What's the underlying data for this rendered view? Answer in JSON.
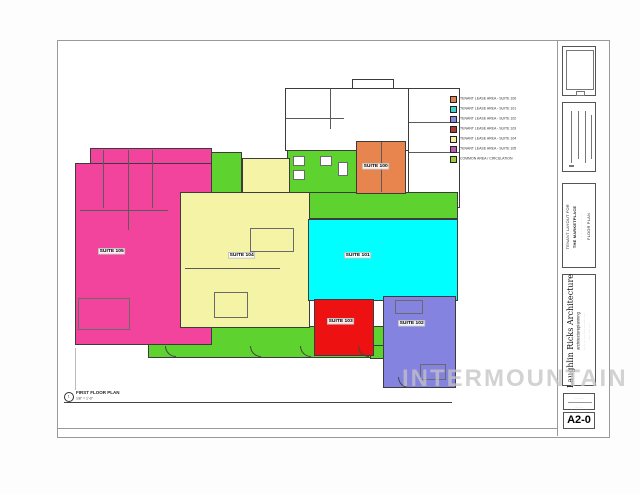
{
  "watermark": "INTERMOUNTAIN",
  "drawing_label": {
    "number": "1",
    "title": "FIRST FLOOR PLAN",
    "scale": "1/8\" = 1'-0\""
  },
  "legend": {
    "items": [
      {
        "label": "TENANT LEASE AREA - SUITE 100",
        "color": "#e0824c"
      },
      {
        "label": "TENANT LEASE AREA - SUITE 101",
        "color": "#44cfcb"
      },
      {
        "label": "TENANT LEASE AREA - SUITE 102",
        "color": "#8886dd"
      },
      {
        "label": "TENANT LEASE AREA - SUITE 103",
        "color": "#b23a34"
      },
      {
        "label": "TENANT LEASE AREA - SUITE 104",
        "color": "#f2efa0"
      },
      {
        "label": "TENANT LEASE AREA - SUITE 105",
        "color": "#b75bb0"
      },
      {
        "label": "COMMON AREA / CIRCULATION",
        "color": "#9acd3c"
      }
    ]
  },
  "suites": [
    {
      "id": "suite-100",
      "label": "SUITE 100",
      "color": "#e8854e"
    },
    {
      "id": "suite-101",
      "label": "SUITE 101",
      "color": "#00ffff"
    },
    {
      "id": "suite-102",
      "label": "SUITE 102",
      "color": "#8583e0"
    },
    {
      "id": "suite-103",
      "label": "SUITE 103",
      "color": "#ee1111"
    },
    {
      "id": "suite-104",
      "label": "SUITE 104",
      "color": "#f5f3a5"
    },
    {
      "id": "suite-105",
      "label": "SUITE 105",
      "color": "#f2449c"
    }
  ],
  "common_color": "#5ed32f",
  "titleblock": {
    "project": {
      "line1": "TENANT LAYOUT FOR",
      "line2": "THE MARKETPLACE",
      "line3": "· · · · · · · · · ·",
      "line4": "FLOOR PLAN"
    },
    "firm": {
      "name": "Laughlin Ricks Architecture",
      "tagline": "architectureplanning",
      "address": "··· ·· ··· ···· ····· ····· ···· ·····",
      "phone": "····· ····· ·····"
    },
    "info_box": {
      "line1": "······ · ··",
      "line2": "···· ···"
    },
    "sheet_number": "A2-0"
  }
}
